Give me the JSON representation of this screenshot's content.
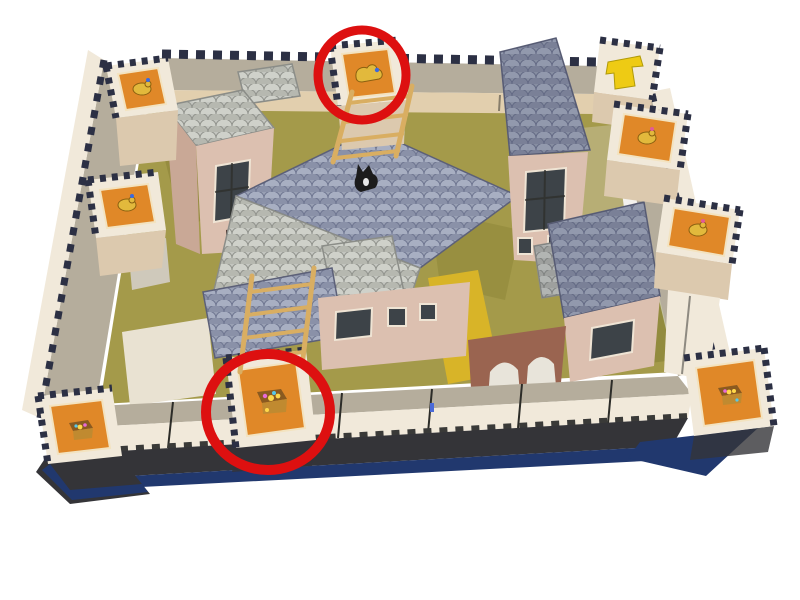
{
  "scene": {
    "type": "photograph",
    "subject": "Papercraft model of a walled medieval town viewed from above; two wall-tower tops are highlighted with red circles",
    "background": "#ffffff"
  },
  "colors": {
    "annotation_red": "#dd1010",
    "tile_orange": "#e08828",
    "tile_yellow": "#eecb14",
    "roof_blue": "#99a0b4",
    "roof_light": "#c4c6c0",
    "building_pink": "#dcc0b0",
    "building_pink_dark": "#c9a896",
    "walkway_gray": "#b5ad9c",
    "wall_cream": "#f1e9da",
    "tower_tan": "#dcc9ae",
    "courtyard_olive": "#a49a4a",
    "path_yellow": "#d8b428",
    "window_dark": "#3d4348",
    "teeth_dark": "#2c3044",
    "base_dark": "#343438",
    "box_navy": "#21386e",
    "ladder_wood": "#d9ae62",
    "brick_red": "#9a6450",
    "glyph_gold": "#e2b93c",
    "chest_brown": "#8a5a20"
  },
  "annotations": {
    "shape": "red-ellipse-outline",
    "count": 2,
    "items": [
      {
        "id": "top-center",
        "target": "tower-top-center",
        "note": "circle around top-center wall tower with animal figure tile"
      },
      {
        "id": "bottom-center",
        "target": "tower-bottom-center",
        "note": "circle around bottom-wall tower with treasure chest tile"
      }
    ]
  },
  "towers": [
    {
      "id": "top-left-corner",
      "tile": "orange",
      "icon": "animal-figure",
      "circled": false
    },
    {
      "id": "top-center",
      "tile": "orange",
      "icon": "animal-figure",
      "circled": true
    },
    {
      "id": "top-right-corner",
      "tile": "cream",
      "icon": "yellow-symbol",
      "circled": false
    },
    {
      "id": "right-upper",
      "tile": "orange",
      "icon": "animal-figure",
      "circled": false
    },
    {
      "id": "right-middle",
      "tile": "orange",
      "icon": "animal-figure",
      "circled": false
    },
    {
      "id": "bottom-right-corner",
      "tile": "orange",
      "icon": "treasure-chest",
      "circled": false
    },
    {
      "id": "bottom-center",
      "tile": "orange",
      "icon": "treasure-chest",
      "circled": true
    },
    {
      "id": "bottom-left-corner",
      "tile": "orange",
      "icon": "treasure-chest",
      "circled": false
    },
    {
      "id": "left-middle",
      "tile": "orange",
      "icon": "animal-figure",
      "circled": false
    }
  ],
  "props": {
    "ladders": 2,
    "black_cat_figures": 1,
    "scale_roof_buildings": 7,
    "walls": [
      "top",
      "left",
      "right",
      "bottom"
    ],
    "base": "dark blue box"
  }
}
